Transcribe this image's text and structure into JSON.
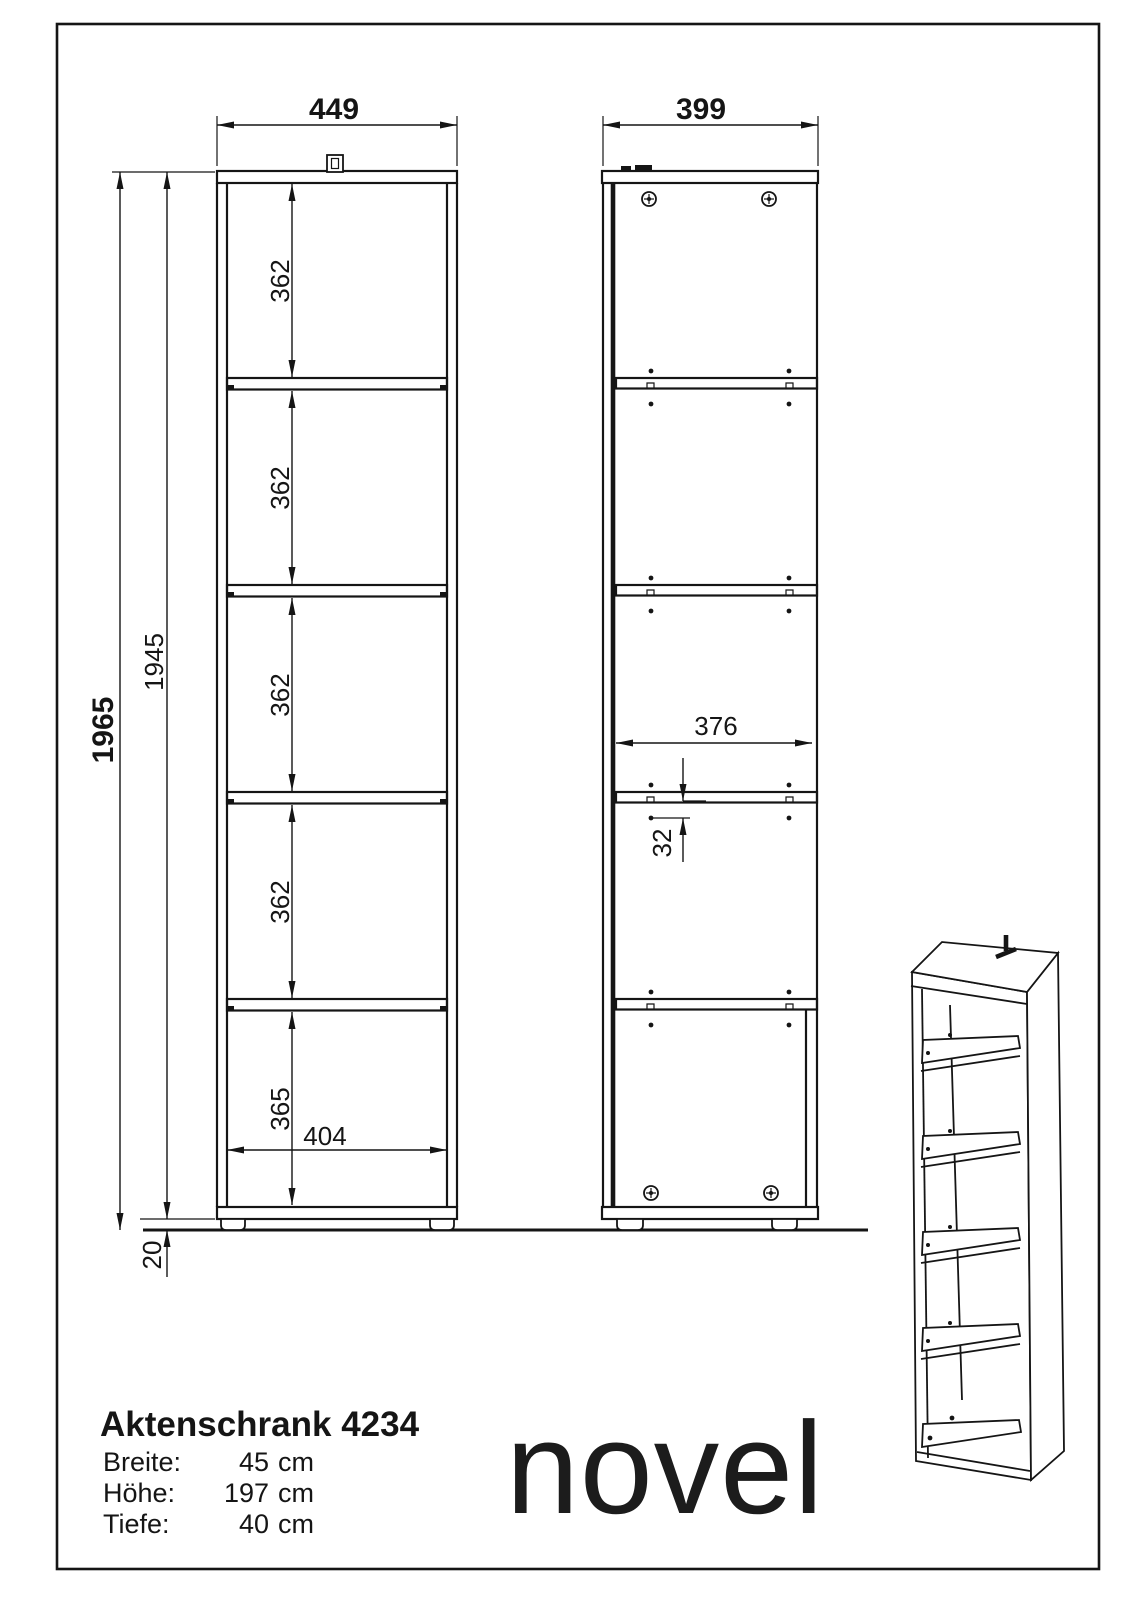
{
  "drawing": {
    "front_view": {
      "width": "449",
      "inner_width": "404",
      "total_height": "1965",
      "body_height": "1945",
      "compartments": [
        "362",
        "362",
        "362",
        "362",
        "365"
      ],
      "foot_height": "20"
    },
    "side_view": {
      "depth": "399",
      "inner_depth": "376",
      "shelf_offset": "32"
    }
  },
  "product": {
    "title": "Aktenschrank 4234",
    "specs": [
      {
        "label": "Breite:",
        "value": "45",
        "unit": "cm"
      },
      {
        "label": "Höhe:",
        "value": "197",
        "unit": "cm"
      },
      {
        "label": "Tiefe:",
        "value": "40",
        "unit": "cm"
      }
    ],
    "brand": "novel"
  }
}
